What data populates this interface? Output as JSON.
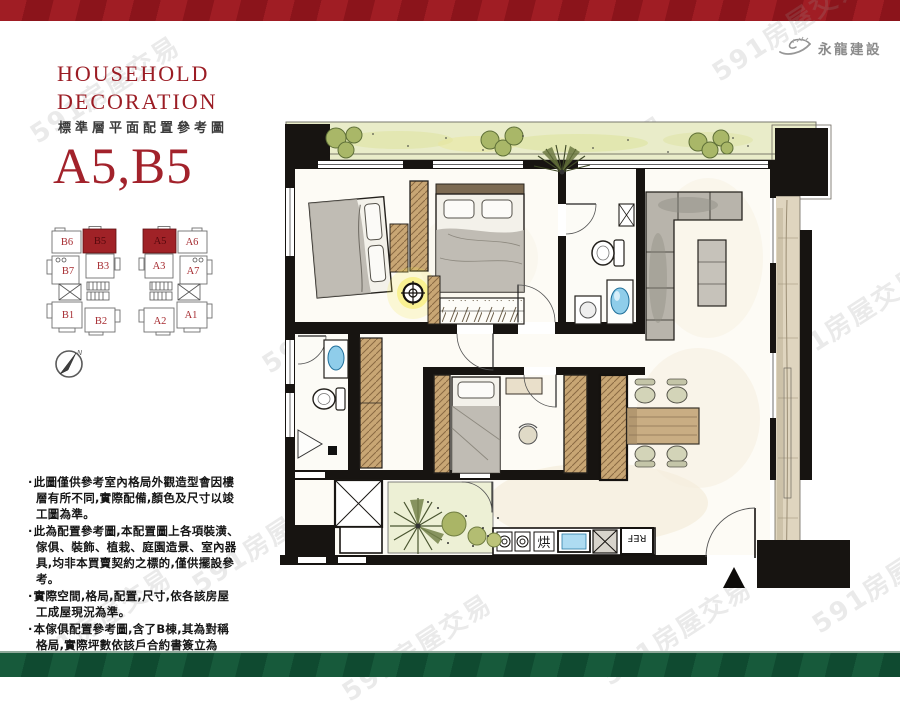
{
  "brand": {
    "name": "永龍建設"
  },
  "header": {
    "title_line1": "HOUSEHOLD",
    "title_line2": "DECORATION",
    "subtitle": "標準層平面配置參考圖",
    "unit_title": "A5,B5"
  },
  "key_plan": {
    "building_b": {
      "cells": [
        {
          "label": "B6",
          "highlight": false
        },
        {
          "label": "B5",
          "highlight": true
        },
        {
          "label": "B7",
          "highlight": false
        },
        {
          "label": "B3",
          "highlight": false
        },
        {
          "label": "B1",
          "highlight": false
        },
        {
          "label": "B2",
          "highlight": false
        }
      ]
    },
    "building_a": {
      "cells": [
        {
          "label": "A5",
          "highlight": true
        },
        {
          "label": "A6",
          "highlight": false
        },
        {
          "label": "A3",
          "highlight": false
        },
        {
          "label": "A7",
          "highlight": false
        },
        {
          "label": "A2",
          "highlight": false
        },
        {
          "label": "A1",
          "highlight": false
        }
      ]
    }
  },
  "compass": {
    "north_label": "N"
  },
  "disclaimer": {
    "bullets": [
      "此圖僅供參考室內格局外觀造型會因樓層有所不同,實際配備,顏色及尺寸以竣工圖為準。",
      "此為配置參考圖,本配置圖上各項裝潢、傢俱、裝飾、植栽、庭園造景、室內器具,均非本買賣契約之標的,僅供擺設參考。",
      "實際空間,格局,配置,尺寸,依各該房屋工成屋現況為準。",
      "本傢俱配置參考圖,含了B棟,其為對稱格局,實際坪數依該戶合約書簽立為準。"
    ]
  },
  "floor_plan": {
    "labels": {
      "dryer": "烘",
      "fridge": "REF"
    }
  },
  "watermark": {
    "text": "591房屋交易"
  },
  "colors": {
    "accent_red": "#9e1b23",
    "band_green": "#165a3b",
    "highlight_unit": "#a02227",
    "plan_wall": "#171411",
    "water_blue": "#8fcdea",
    "plant_green": "#a9b768"
  }
}
